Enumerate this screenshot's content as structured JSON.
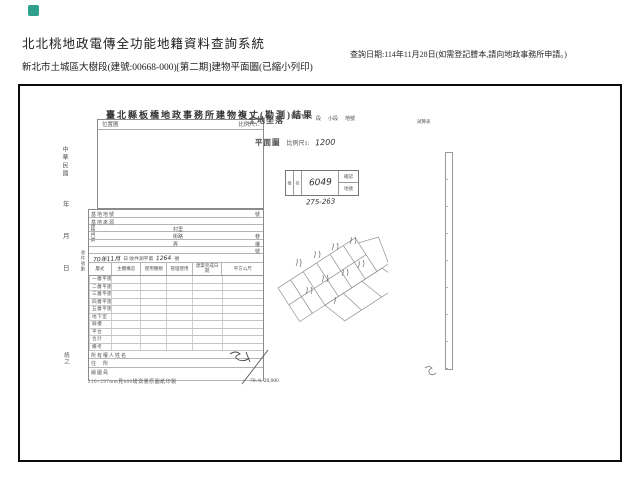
{
  "header": {
    "system_title": "北北桃地政電傳全功能地籍資料查詢系統",
    "document_line": "新北市土城區大樹段(建號:00668-000)[第二期]建物平面圖(已縮小列印)",
    "query_date": "查詢日期:114年11月28日(如需登記謄本,請向地政事務所申請。)"
  },
  "form": {
    "title": "臺北縣板橋地政事務所建物複丈(勘測)結果",
    "location_label": "位置圖",
    "location_scale": "比例尺1:",
    "margin": {
      "era": "中華民國",
      "year": "年",
      "month": "月",
      "day": "日",
      "receipt": "收件號數",
      "bottom": "統之"
    },
    "site": {
      "row1": "基地地號",
      "row1_suffix": "號",
      "row2": "基地來源",
      "addr_label": "建物門牌",
      "addr1_mid": "村里",
      "addr2_mid": "街路",
      "addr2_right": "巷",
      "addr3_mid": "弄",
      "addr3_right": "樓",
      "addr4_right": "號",
      "survey_hand_date": "70年11月",
      "survey_printed": "日 收件測字第",
      "survey_hand_no": "1264",
      "survey_suffix": "號"
    },
    "table_headers": [
      "層式",
      "主體構造",
      "使用種類",
      "管理使用",
      "建築完成日期",
      "平方公尺"
    ],
    "floors": [
      "一層平圖式",
      "二層平圖式",
      "三層平圖式",
      "四層平圖式",
      "五層平圖式",
      "地下室",
      "騎樓",
      "平台",
      "合計",
      "備考"
    ],
    "owners": [
      "所有權人姓名",
      "住　所",
      "繪圖員"
    ],
    "footer_note": "210×297mm見600磅測量原圖紙印製",
    "footer_code": "70. 6. 20,000"
  },
  "land": {
    "label": "土地坐落",
    "col1": "鄉鎮市區",
    "col2": "段",
    "col3": "小段",
    "col4": "地號",
    "right_note": "試算表"
  },
  "plan": {
    "label": "平面圖",
    "scale_label": "比例尺1:",
    "scale_value": "1200"
  },
  "stamp": {
    "left1": "檢",
    "left2": "核",
    "value": "6049",
    "right_top": "確認",
    "right_bottom": "地號",
    "below": "275-263"
  },
  "colors": {
    "accent": "#2fa08c",
    "scan_line": "#9a9a9a",
    "ink": "#3c3c3c"
  }
}
